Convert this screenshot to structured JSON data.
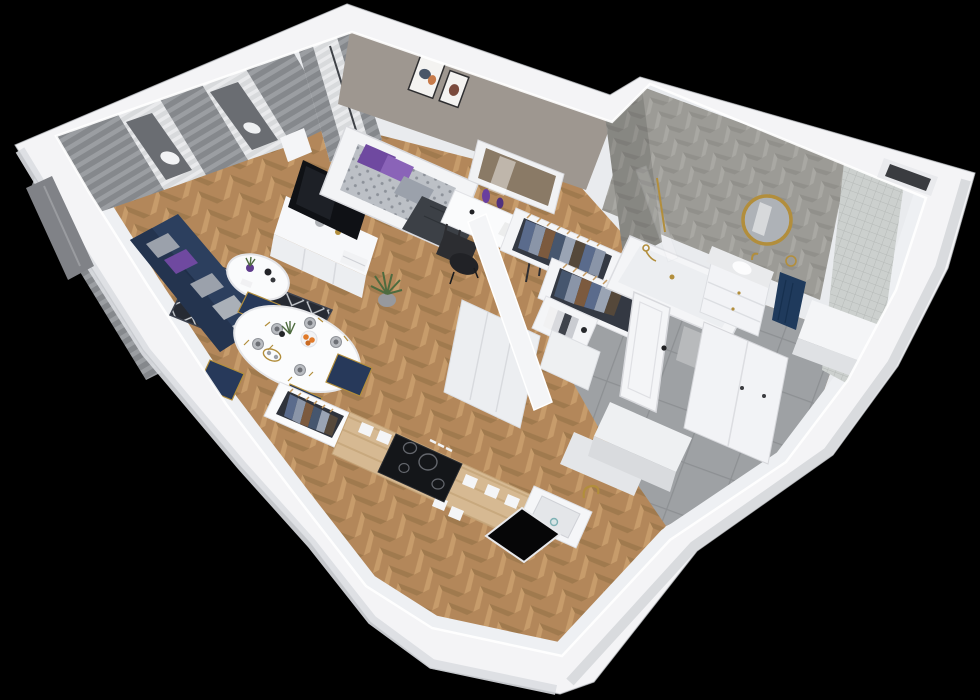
{
  "meta": {
    "title": "3D apartment cutaway floor plan render",
    "view": "isometric top-down dollhouse view on black background",
    "visible_text": "none"
  },
  "palette": {
    "background": "#000000",
    "wall_top": "#f4f4f6",
    "wall_side_sw": "#dcdee2",
    "wall_side_se": "#d6d8dc",
    "wall_inner": "#e9ebee",
    "wall_crest_highlight": "#ffffff",
    "taupe_wall": "#9e9790",
    "wood_floor": "#b3875a",
    "wood_light": "#c79c6b",
    "wood_dark": "#a07a4e",
    "counter_wood": "#d6b992",
    "tile_floor": "#9ea1a4",
    "tile_line": "#8d9093",
    "chevron_tile": "#9c9b96",
    "mosaic_tile": "#ccd0ce",
    "rug_dark": "#262a33",
    "rug_lattice": "#c9cdd2",
    "sofa_navy": "#2c3f5e",
    "sofa_shadow": "#24344f",
    "pillow_purple": "#6f49a0",
    "pillow_purple_light": "#8a63b8",
    "pillow_gray": "#9ba1ab",
    "pillow_white": "#c2c6cc",
    "curtain_gray": "#85888c",
    "curtain_stripe": "#9b9ea2",
    "sheer_white": "#d8dadc",
    "glass_dark": "#6a6d72",
    "furniture_white": "#f7f8fa",
    "furniture_front": "#eceef1",
    "furniture_edge": "#dcdee2",
    "tv_black": "#0f1115",
    "cooktop_black": "#141619",
    "window_black": "#060607",
    "chair_black": "#2c2d31",
    "chair_navy": "#27395a",
    "gold": "#b28e3c",
    "towel_navy": "#1f3a5c",
    "marble": "#e9eaec",
    "duvet_gray": "#bcc0c6",
    "throw_dark": "#3c4046",
    "plant_green": "#4e6b3f",
    "orange_fruit": "#e07a2a",
    "mirror_reflection": "#8a7a66",
    "clothes_blue": "#5a6b8c",
    "clothes_light": "#8a95a8",
    "clothes_brown": "#7c5a3e",
    "clothes_dark": "#46566e",
    "hanger_tan": "#c49a62",
    "closet_interior": "#343943"
  },
  "scene": {
    "rooms": [
      {
        "name": "living-room",
        "items": [
          "gray-curtains",
          "sheer-curtains",
          "balcony-window",
          "navy-corner-sofa",
          "five-throw-pillows",
          "patterned-area-rug",
          "round-coffee-table",
          "tv-sideboard",
          "flatscreen-tv",
          "floor-plant"
        ]
      },
      {
        "name": "dining-area",
        "items": [
          "oval-dining-table",
          "navy-gold-chairs-x4",
          "place-settings-x5",
          "orange-fruit-bowl",
          "gold-tray",
          "clothes-niche-under-window"
        ]
      },
      {
        "name": "bedroom",
        "items": [
          "double-bed",
          "purple-pillows",
          "gray-patterned-duvet",
          "vanity-desk",
          "leaning-mirror",
          "black-desk-chair",
          "two-wall-art-frames",
          "window-sheer-curtain"
        ]
      },
      {
        "name": "walk-in-closet",
        "items": [
          "open-clothes-rack-large",
          "open-clothes-rack-small",
          "book-shelf",
          "storage-cabinet"
        ]
      },
      {
        "name": "hallway",
        "items": [
          "gray-tile-floor",
          "open-white-door",
          "built-in-cabinets",
          "white-wardrobe",
          "storage-blocks"
        ]
      },
      {
        "name": "bathroom",
        "items": [
          "bathtub-gold-fixtures",
          "glass-shower-screen",
          "vanity-unit-marble-top",
          "round-gold-mirror",
          "navy-towel",
          "chevron-tile-walls",
          "mosaic-shower-wall",
          "white-ledge",
          "window-opening"
        ]
      },
      {
        "name": "kitchen",
        "items": [
          "wood-countertop",
          "induction-cooktop-4-burners",
          "white-sink-gold-faucet",
          "drawer-handles",
          "window-opening-black",
          "appliance-blocks"
        ]
      }
    ],
    "counts": {
      "cooktop_burners": 4,
      "wall_art_frames": 2,
      "dining_chairs": 4,
      "dining_plates": 5,
      "sofa_pillows": 5,
      "clothes_racks": 3
    }
  }
}
